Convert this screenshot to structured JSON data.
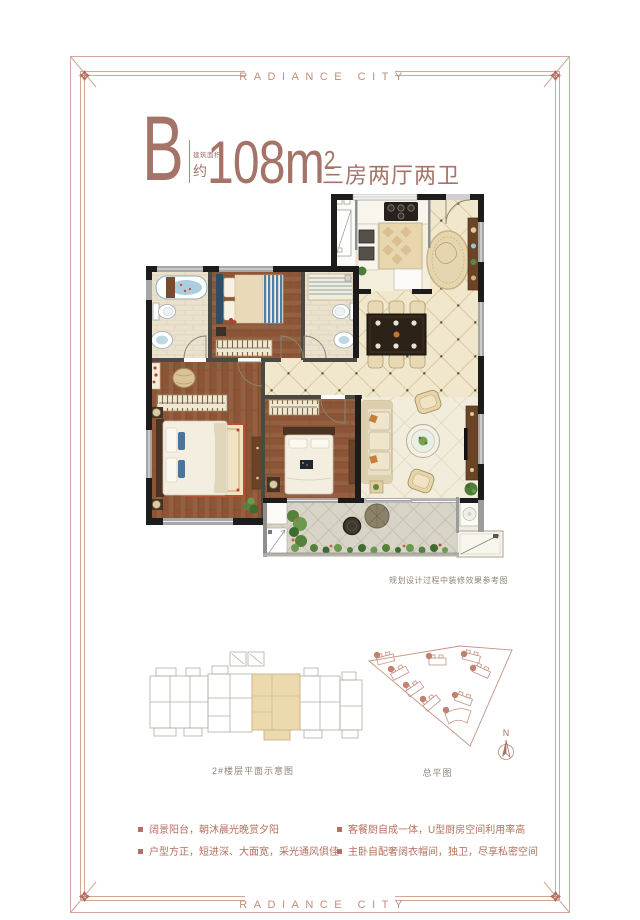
{
  "frame": {
    "brand_top": "RADIANCE CITY",
    "brand_bottom": "RADIANCE CITY"
  },
  "title": {
    "unit": "B",
    "area_label": "建筑面积",
    "area_approx": "约",
    "area_number": "108",
    "area_unit": "m",
    "area_exponent": "2",
    "layout": "三房两厅两卫"
  },
  "plan": {
    "note": "规划设计过程中装修效果参考图"
  },
  "diagrams": {
    "floor_schematic_caption": "2#楼层平面示意图",
    "site_plan_caption": "总平图",
    "compass_label": "N"
  },
  "features": {
    "items": [
      "阔景阳台，朝沐晨光晚赏夕阳",
      "户型方正，短进深、大面宽，采光通风俱佳",
      "客餐厨自成一体，U型厨房空间利用率高",
      "主卧自配奢阔衣帽间，独卫，尽享私密空间"
    ]
  },
  "colors": {
    "accent": "#b5705f",
    "frame_line": "#cfa79a",
    "title_text": "#a57468",
    "caption_text": "#8f8578",
    "highlight_unit": "#ecd9ad"
  }
}
